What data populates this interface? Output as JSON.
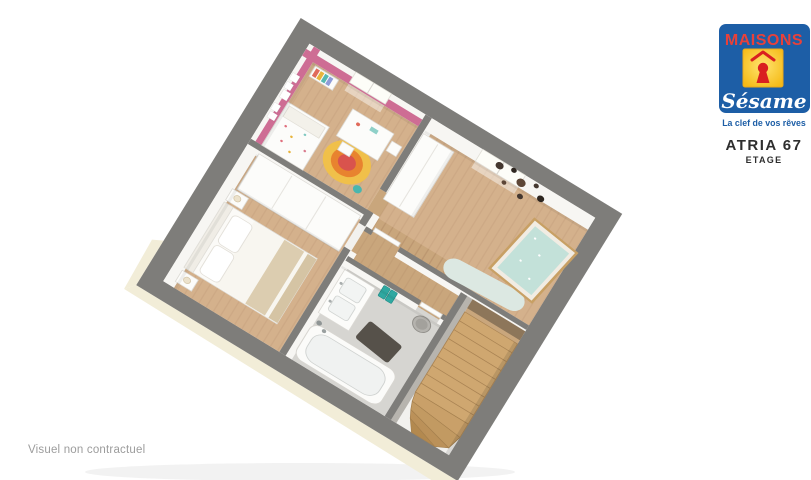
{
  "brand": {
    "name": "MAISONS",
    "script_name": "Sésame",
    "tagline": "La clef de vos rêves",
    "colors": {
      "blue": "#1d5ea6",
      "yellow": "#f8c61f",
      "yellow_light": "#ffe470",
      "red": "#e8413a",
      "keyhole_red": "#d92020"
    }
  },
  "plan": {
    "title": "ATRIA 67",
    "subtitle": "ETAGE"
  },
  "footer": {
    "disclaimer": "Visuel non contractuel"
  },
  "floorplan": {
    "rooms": [
      "child-bedroom",
      "nursery",
      "master-bedroom",
      "hallway",
      "bathroom",
      "staircase"
    ],
    "colors": {
      "exterior_wall": "#7e7d7a",
      "interior_wall_face": "#f7f6f3",
      "slab": "#f2edd8",
      "wood_floor": "#d4b18c",
      "hallway_wood": "#c9a67c",
      "tile_floor": "#d6d5d1",
      "stair_wood": "#cfa770",
      "accent_pink": "#ce6d94",
      "accent_teal": "#2fa8a1",
      "crib_wood": "#c8a064",
      "rug_red": "#d9534d",
      "rug_orange": "#e8832f",
      "rug_yellow": "#f0c04a"
    }
  }
}
